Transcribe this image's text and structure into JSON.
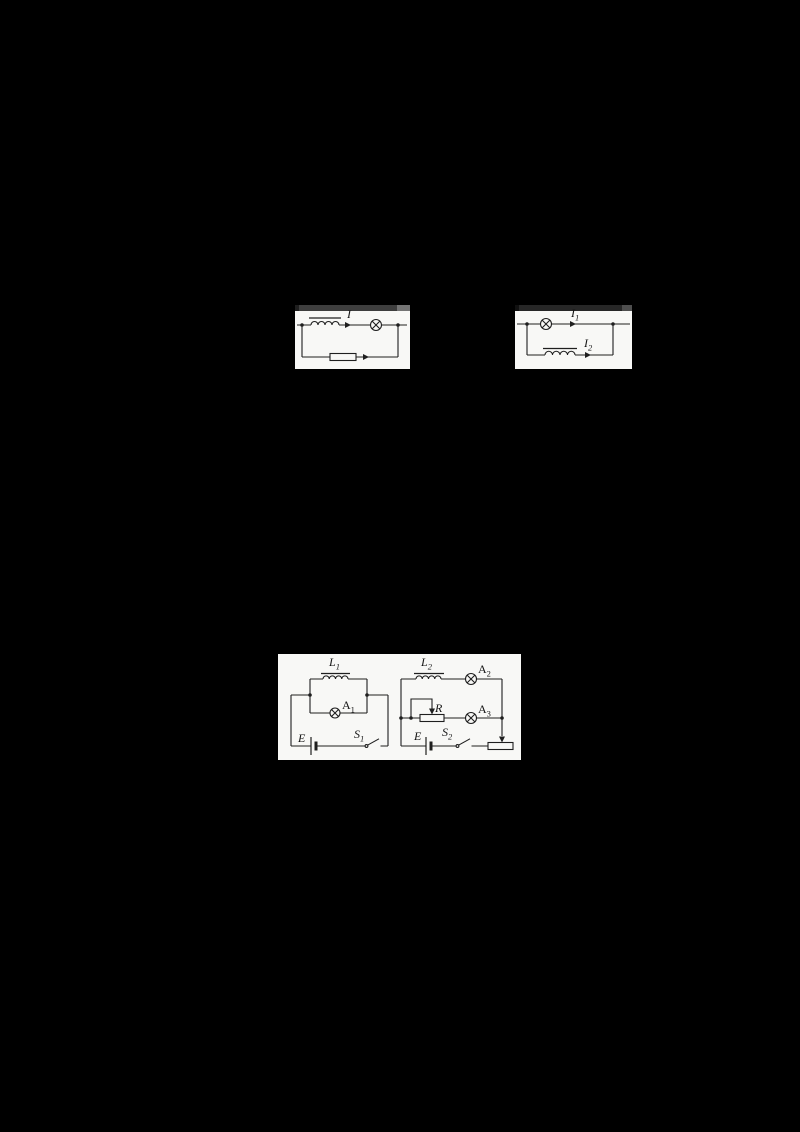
{
  "colors": {
    "page_background": "#000000",
    "card_background": "#f8f8f6",
    "line": "#1f1f1f",
    "strip1_main": "#3e3e3e",
    "strip1_cap": "#747474",
    "strip2_main": "#272727",
    "strip2_cap": "#4e4e4e"
  },
  "figures": {
    "series_circuit": {
      "current": {
        "base": "I",
        "sub": ""
      }
    },
    "parallel_circuit": {
      "current_lamp": {
        "base": "I",
        "sub": "1"
      },
      "current_inductor": {
        "base": "I",
        "sub": "2"
      }
    },
    "experiment_left": {
      "inductor": {
        "base": "L",
        "sub": "1"
      },
      "lamp": {
        "base": "A",
        "sub": "1"
      },
      "battery": {
        "base": "E",
        "sub": ""
      },
      "switch": {
        "base": "S",
        "sub": "1"
      }
    },
    "experiment_right": {
      "inductor": {
        "base": "L",
        "sub": "2"
      },
      "lamp_top": {
        "base": "A",
        "sub": "2"
      },
      "lamp_mid": {
        "base": "A",
        "sub": "3"
      },
      "rheostat": {
        "base": "R",
        "sub": ""
      },
      "battery": {
        "base": "E",
        "sub": ""
      },
      "switch": {
        "base": "S",
        "sub": "2"
      }
    }
  }
}
